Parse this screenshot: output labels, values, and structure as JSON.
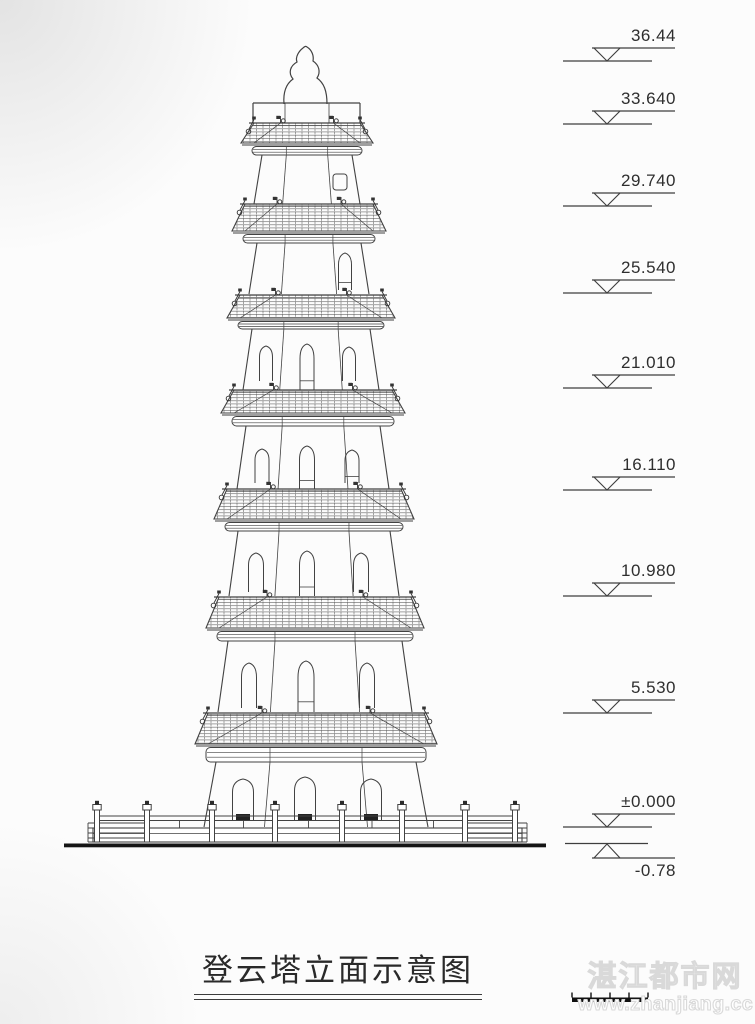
{
  "drawing": {
    "title": "登云塔立面示意图"
  },
  "elevations": [
    {
      "label": "36.44"
    },
    {
      "label": "33.640"
    },
    {
      "label": "29.740"
    },
    {
      "label": "25.540"
    },
    {
      "label": "21.010"
    },
    {
      "label": "16.110"
    },
    {
      "label": "10.980"
    },
    {
      "label": "5.530"
    },
    {
      "label": "±0.000"
    },
    {
      "label": "-0.78"
    }
  ],
  "watermark": {
    "site_name": "湛江都市网",
    "site_url": "www.zhanjiang.cc"
  },
  "colors": {
    "line": "#424242",
    "ground": "#151515",
    "background": "#fcfcfc"
  }
}
